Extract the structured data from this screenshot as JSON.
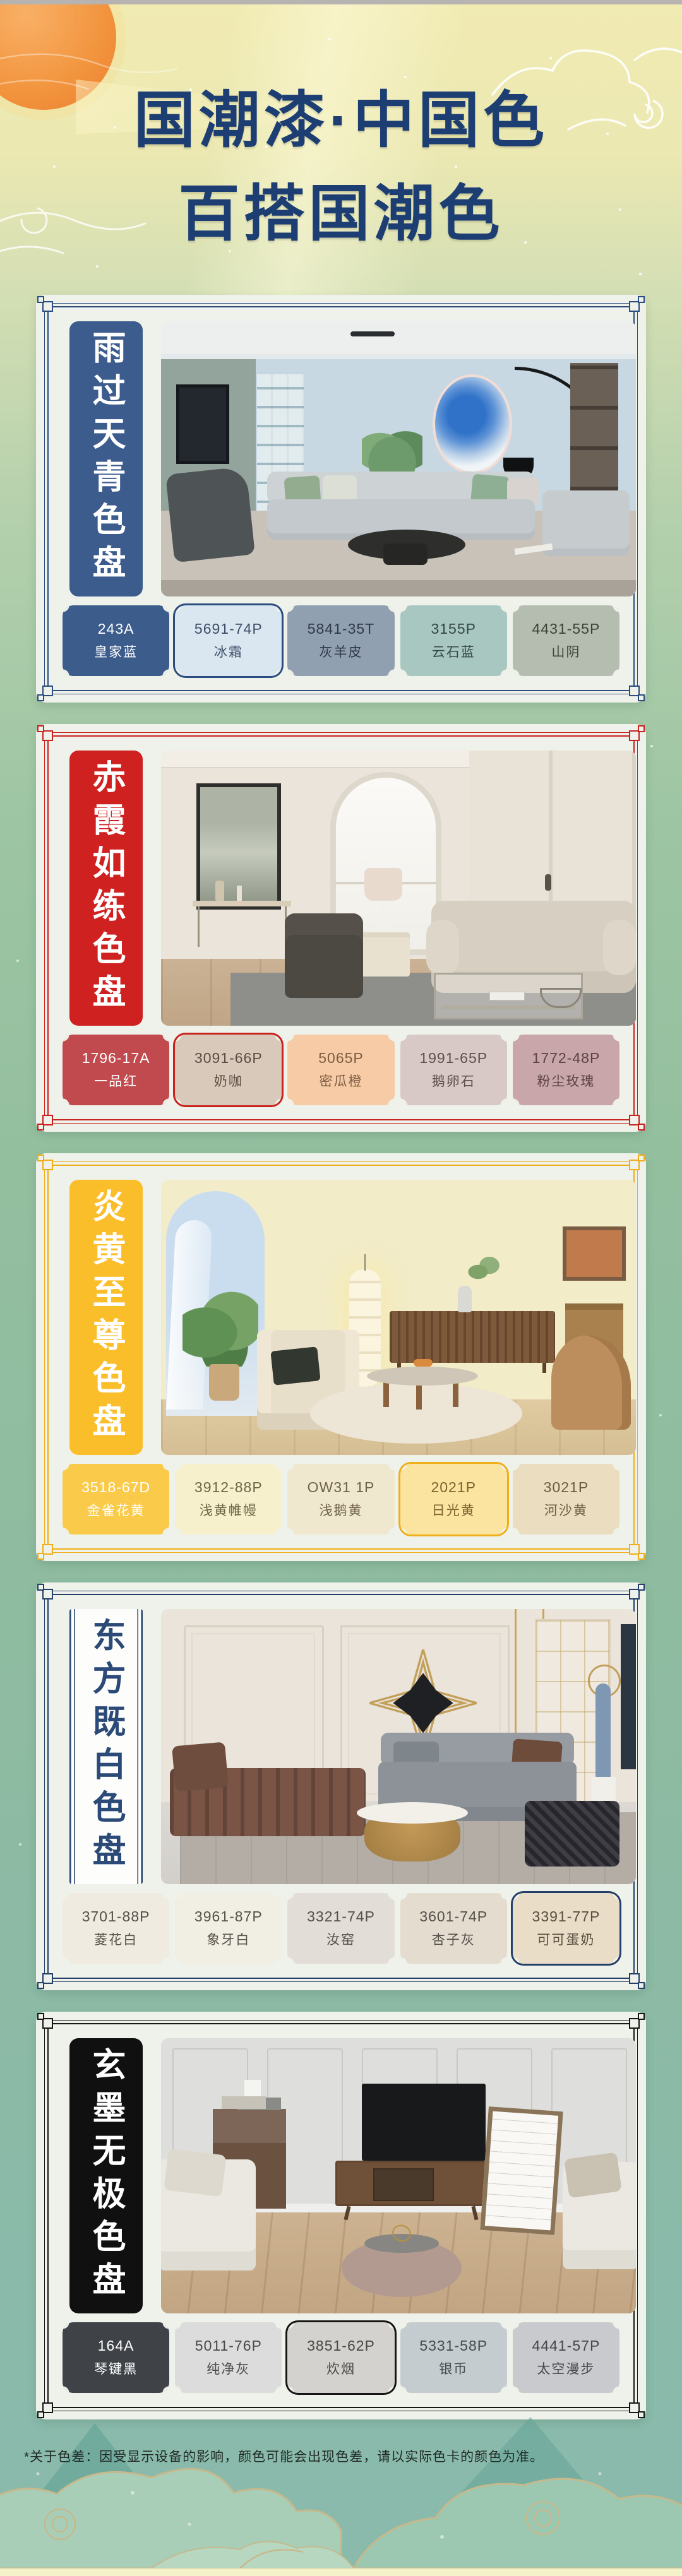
{
  "page": {
    "title_line1": "国潮漆·中国色",
    "title_line2": "百搭国潮色",
    "title_color": "#1D3E73",
    "footer_note": "*关于色差：因受显示设备的影响，颜色可能会出现色差，请以实际色卡的颜色为准。"
  },
  "cards": [
    {
      "title": "雨过天青色盘",
      "accent": "#2B4C7E",
      "banner_bg": "#3B5C8D",
      "banner_text": "#FFFFFF",
      "swatches": [
        {
          "code": "243A",
          "name": "皇家蓝",
          "color": "#3C5C8C",
          "text": "#FFFFFF",
          "selected": false
        },
        {
          "code": "5691-74P",
          "name": "冰霜",
          "color": "#DAE7F1",
          "text": "#3E4E68",
          "selected": true
        },
        {
          "code": "5841-35T",
          "name": "灰羊皮",
          "color": "#91A0B1",
          "text": "#2F3947",
          "selected": false
        },
        {
          "code": "3155P",
          "name": "云石蓝",
          "color": "#A8C7C0",
          "text": "#364845",
          "selected": false
        },
        {
          "code": "4431-55P",
          "name": "山阴",
          "color": "#B5BDB0",
          "text": "#3B4439",
          "selected": false
        }
      ]
    },
    {
      "title": "赤霞如练色盘",
      "accent": "#C9211E",
      "banner_bg": "#CE2120",
      "banner_text": "#FFFFFF",
      "swatches": [
        {
          "code": "1796-17A",
          "name": "一品红",
          "color": "#C14A4E",
          "text": "#FFFFFF",
          "selected": false
        },
        {
          "code": "3091-66P",
          "name": "奶咖",
          "color": "#D9C9BB",
          "text": "#5B4B41",
          "selected": true
        },
        {
          "code": "5065P",
          "name": "密瓜橙",
          "color": "#F6CBA5",
          "text": "#7D5C43",
          "selected": false
        },
        {
          "code": "1991-65P",
          "name": "鹅卵石",
          "color": "#D8C8C6",
          "text": "#5E4F4E",
          "selected": false
        },
        {
          "code": "1772-48P",
          "name": "粉尘玫瑰",
          "color": "#C8A6A9",
          "text": "#5C4245",
          "selected": false
        }
      ]
    },
    {
      "title": "炎黄至尊色盘",
      "accent": "#F0AE19",
      "banner_bg": "#FBBE2B",
      "banner_text": "#FFFFFF",
      "swatches": [
        {
          "code": "3518-67D",
          "name": "金雀花黄",
          "color": "#FACB4B",
          "text": "#FFFFFF",
          "selected": false
        },
        {
          "code": "3912-88P",
          "name": "浅黄帷幔",
          "color": "#F6F0CD",
          "text": "#6F6647",
          "selected": false
        },
        {
          "code": "OW31 1P",
          "name": "浅鹅黄",
          "color": "#F0E7CF",
          "text": "#6E6349",
          "selected": false
        },
        {
          "code": "2021P",
          "name": "日光黄",
          "color": "#FBE49F",
          "text": "#7A6330",
          "selected": true
        },
        {
          "code": "3021P",
          "name": "河沙黄",
          "color": "#EBDDBF",
          "text": "#6B5D42",
          "selected": false
        }
      ]
    },
    {
      "title": "东方既白色盘",
      "accent": "#233F6A",
      "banner_bg": "#FDFEFB",
      "banner_text": "#2C4A78",
      "swatches": [
        {
          "code": "3701-88P",
          "name": "菱花白",
          "color": "#EFEBE0",
          "text": "#57524B",
          "selected": false
        },
        {
          "code": "3961-87P",
          "name": "象牙白",
          "color": "#F1EEE3",
          "text": "#57524B",
          "selected": false
        },
        {
          "code": "3321-74P",
          "name": "汝窑",
          "color": "#E3DDD7",
          "text": "#55504C",
          "selected": false
        },
        {
          "code": "3601-74P",
          "name": "杏子灰",
          "color": "#E3DCCF",
          "text": "#56504A",
          "selected": false
        },
        {
          "code": "3391-77P",
          "name": "可可蛋奶",
          "color": "#EADDC7",
          "text": "#584F40",
          "selected": true
        }
      ]
    },
    {
      "title": "玄墨无极色盘",
      "accent": "#161616",
      "banner_bg": "#101010",
      "banner_text": "#FFFFFF",
      "swatches": [
        {
          "code": "164A",
          "name": "琴键黑",
          "color": "#3F4348",
          "text": "#FFFFFF",
          "selected": false
        },
        {
          "code": "5011-76P",
          "name": "纯净灰",
          "color": "#DCDCDC",
          "text": "#4A4A4A",
          "selected": false
        },
        {
          "code": "3851-62P",
          "name": "炊烟",
          "color": "#D4D2CE",
          "text": "#4A4844",
          "selected": true
        },
        {
          "code": "5331-58P",
          "name": "银币",
          "color": "#C4CCCF",
          "text": "#454B4E",
          "selected": false
        },
        {
          "code": "4441-57P",
          "name": "太空漫步",
          "color": "#C9CACD",
          "text": "#47484C",
          "selected": false
        }
      ]
    }
  ]
}
